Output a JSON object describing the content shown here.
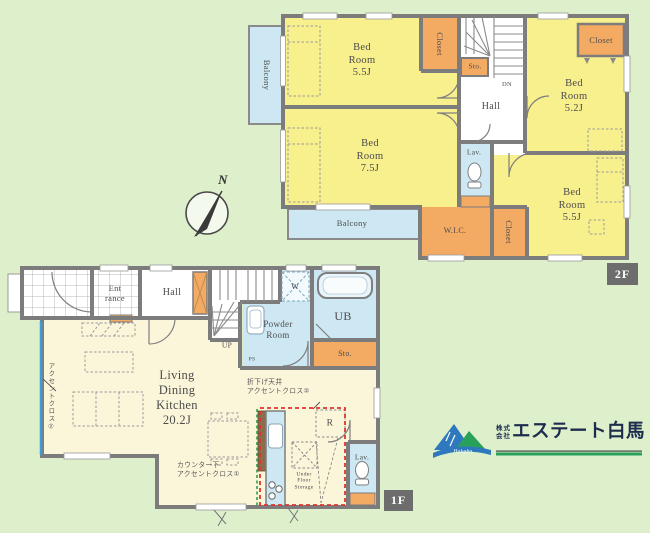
{
  "floor2": {
    "badge": "2F",
    "bedroom_tl": "Bed\nRoom\n5.5J",
    "bedroom_ml": "Bed\nRoom\n7.5J",
    "bedroom_tr": "Bed\nRoom\n5.2J",
    "bedroom_br": "Bed\nRoom\n5.5J",
    "closet_top": "Closet",
    "closet_tr": "Closet",
    "closet_bottom": "Closet",
    "wic": "W.I.C.",
    "sto": "Sto.",
    "hall": "Hall",
    "lav": "Lav.",
    "balcony_left": "Balcony",
    "balcony_bottom": "Balcony",
    "dn": "DN"
  },
  "floor1": {
    "badge": "1F",
    "entrance": "Ent\nrance",
    "hall": "Hall",
    "up": "UP",
    "washer": "W",
    "powder_room": "Powder\nRoom",
    "unit_bath": "UB",
    "sto": "Sto.",
    "ldk": "Living\nDining\nKitchen\n20.2J",
    "fridge": "R",
    "under_floor_storage": "Under\nFloor\nStorage",
    "lav": "Lav.",
    "ps": "PS",
    "annotation_wall": "アクセントクロス②",
    "annotation_ceiling": "折下げ天井\nアクセントクロス②",
    "annotation_counter": "カウンター下\nアクセントクロス①"
  },
  "compass": {
    "north": "N"
  },
  "logo": {
    "prefix": "株式\n会社",
    "company": "エステート白馬",
    "mark_text": "Hakuba"
  },
  "colors": {
    "background_green": "#ddefcb",
    "room_yellow": "#f8ef8d",
    "room_cream": "#fbf5da",
    "storage_orange": "#f3aa62",
    "water_blue": "#cde8f3",
    "wall_gray": "#7c7c7c",
    "accent_red": "#df342c",
    "accent_green": "#2f9e44",
    "accent_blue": "#3f9bd8",
    "logo_navy": "#1d2c4d",
    "logo_green": "#2aa05d"
  }
}
